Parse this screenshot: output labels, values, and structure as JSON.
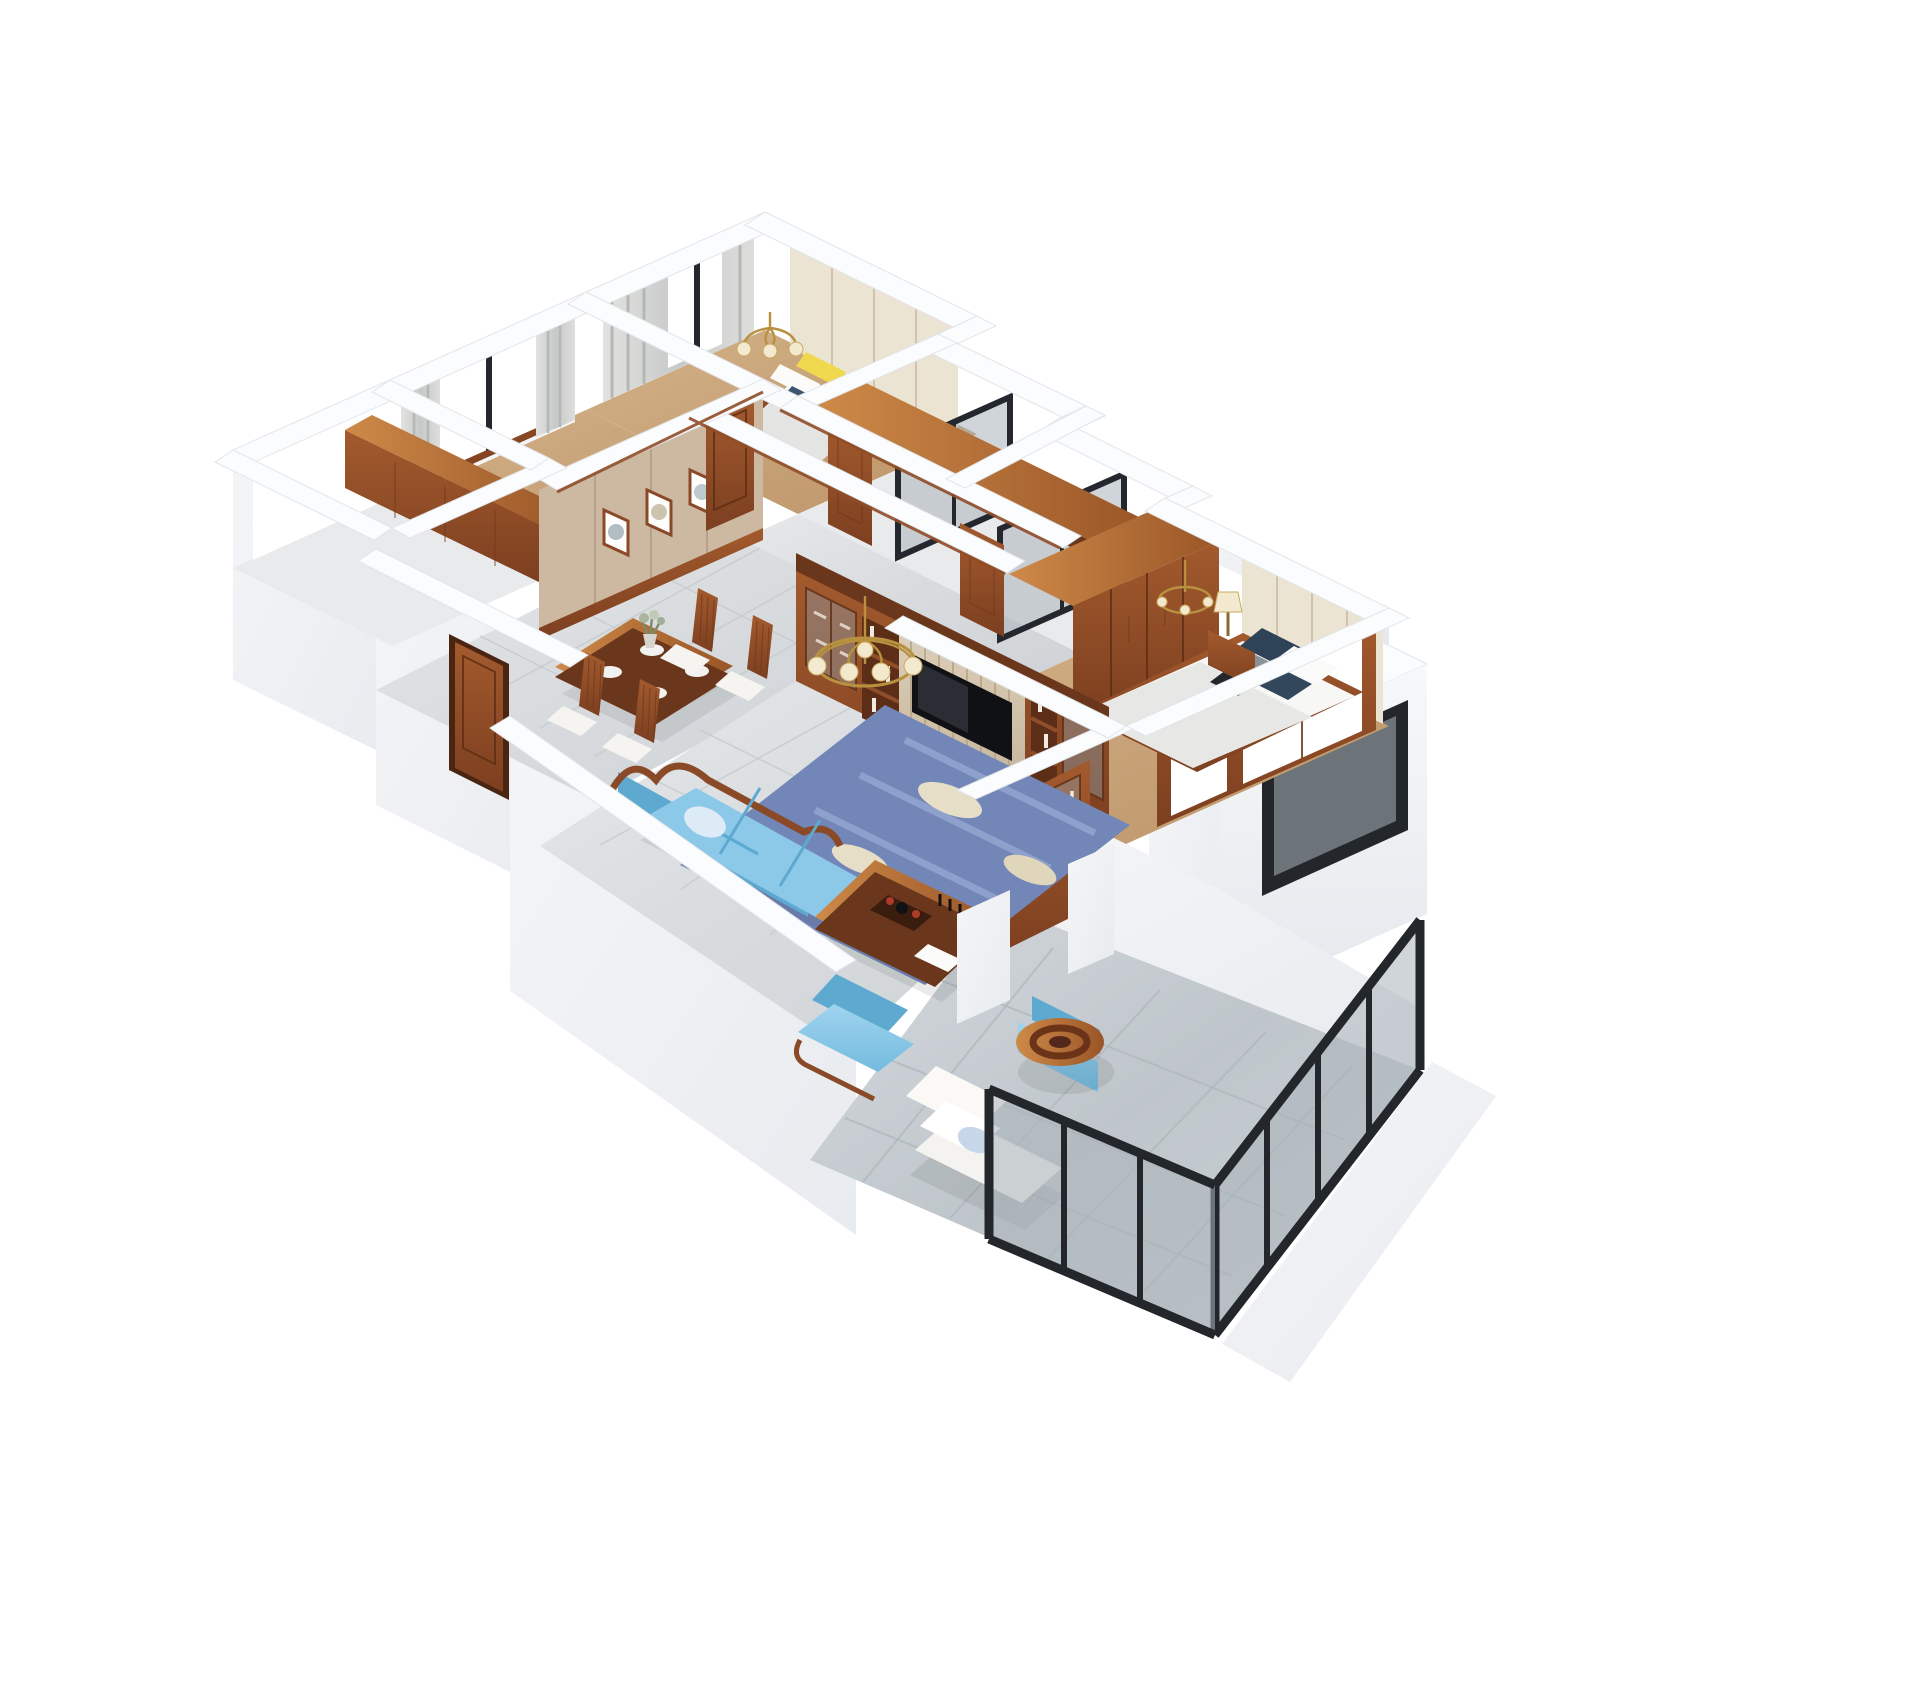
{
  "meta": {
    "description": "3D isometric dollhouse cutaway render of a furnished apartment floor plan on a white background",
    "background": "#ffffff",
    "style": "chinese-classic wood interior"
  },
  "palette": {
    "wall_top": "#fbfcfd",
    "wall_face": "#f1f3f5",
    "wall_shade": "#dfe3e8",
    "floor_tile": "#dfe2e4",
    "floor_wood": "#c9a578",
    "balcony_marble": "#c6ccd1",
    "wood": "#8f4d28",
    "wood_dark": "#6b371c",
    "wood_top": "#c0793e",
    "wall_beige": "#cdb9a2",
    "panel_cream": "#ece4d2",
    "curtain_gray": "#d7d8d6",
    "frame_dark": "#23262b",
    "sofa_blue": "#8cc8e8",
    "rug_blue": "#7287b8",
    "rug_cream": "#e6dec6",
    "pillow_yellow": "#f0d94e",
    "pillow_navy": "#2e4258",
    "brass": "#b8913f",
    "lamp_shade": "#f3e9cf",
    "tv_black": "#101114",
    "bedding_white": "#f7f7f6"
  },
  "scene": {
    "rooms": [
      "back-bedroom",
      "left-bedroom",
      "utility-balcony",
      "corridor",
      "bathroom-a",
      "bathroom-b",
      "master-bedroom",
      "bay-window",
      "dining-room",
      "living-room",
      "balcony"
    ],
    "furniture": [
      "back-bed-yellow-pillows",
      "gray-curtains",
      "sliding-wardrobe",
      "wall-hung-wood-cabinet",
      "framed-art-x3",
      "dining-table-4-chairs",
      "tv-media-wall",
      "television",
      "display-cabinet",
      "wine-cabinet",
      "blue-camelback-sofa",
      "blue-armchairs",
      "wood-coffee-table",
      "blue-leaf-rug",
      "brass-chandeliers",
      "master-bed-navy-pillows",
      "master-wardrobe",
      "nightstand-lamp",
      "white-balcony-armchair",
      "barrel-stool",
      "dark-glass-balcony-glazing"
    ]
  }
}
